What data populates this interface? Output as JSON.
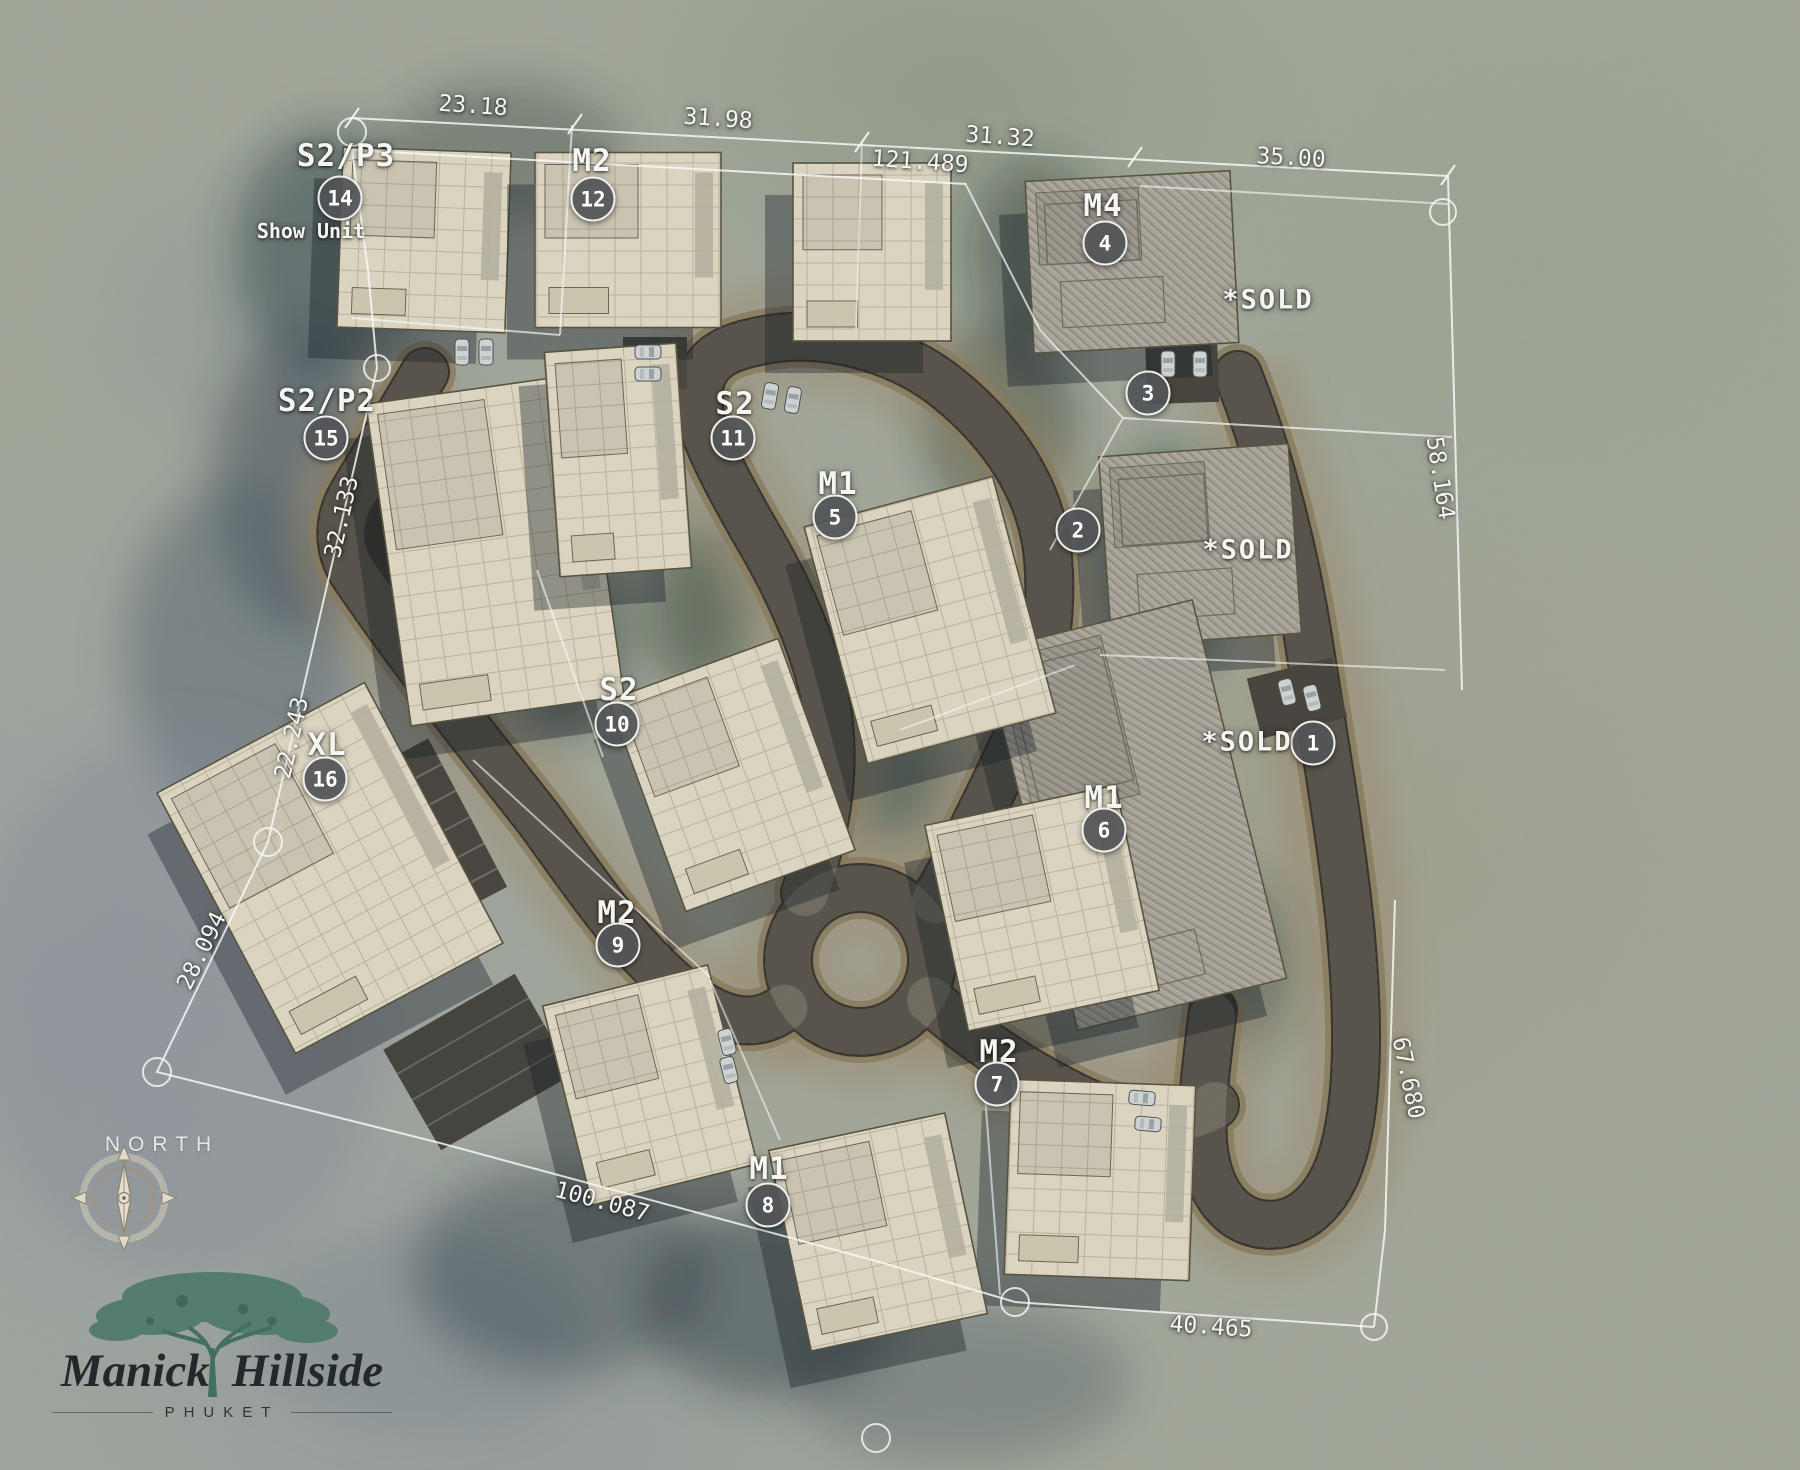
{
  "plots": [
    {
      "type": "S2/P3",
      "number": "14",
      "note": "Show Unit",
      "label": {
        "x": 346,
        "y": 156
      },
      "marker": {
        "x": 340,
        "y": 198
      },
      "note_pos": {
        "x": 311,
        "y": 231
      }
    },
    {
      "type": "M2",
      "number": "12",
      "note": "",
      "label": {
        "x": 592,
        "y": 161
      },
      "marker": {
        "x": 593,
        "y": 199
      }
    },
    {
      "type": "M4",
      "number": "4",
      "note": "",
      "label": {
        "x": 1103,
        "y": 206
      },
      "marker": {
        "x": 1105,
        "y": 243
      }
    },
    {
      "type": "S2",
      "number": "11",
      "note": "",
      "label": {
        "x": 735,
        "y": 404
      },
      "marker": {
        "x": 733,
        "y": 438
      }
    },
    {
      "type": "M1",
      "number": "5",
      "note": "",
      "label": {
        "x": 838,
        "y": 484
      },
      "marker": {
        "x": 835,
        "y": 517
      }
    },
    {
      "type": "S2/P2",
      "number": "15",
      "note": "",
      "label": {
        "x": 327,
        "y": 401
      },
      "marker": {
        "x": 326,
        "y": 438
      }
    },
    {
      "type": "S2",
      "number": "10",
      "note": "",
      "label": {
        "x": 619,
        "y": 690
      },
      "marker": {
        "x": 617,
        "y": 724
      }
    },
    {
      "type": "XL",
      "number": "16",
      "note": "",
      "label": {
        "x": 327,
        "y": 745
      },
      "marker": {
        "x": 325,
        "y": 779
      }
    },
    {
      "type": "M2",
      "number": "9",
      "note": "",
      "label": {
        "x": 617,
        "y": 913
      },
      "marker": {
        "x": 618,
        "y": 945
      }
    },
    {
      "type": "M1",
      "number": "6",
      "note": "",
      "label": {
        "x": 1104,
        "y": 798
      },
      "marker": {
        "x": 1104,
        "y": 830
      }
    },
    {
      "type": "M2",
      "number": "7",
      "note": "",
      "label": {
        "x": 999,
        "y": 1052
      },
      "marker": {
        "x": 997,
        "y": 1084
      }
    },
    {
      "type": "M1",
      "number": "8",
      "note": "",
      "label": {
        "x": 769,
        "y": 1169
      },
      "marker": {
        "x": 768,
        "y": 1205
      }
    },
    {
      "type": "",
      "number": "3",
      "note": "",
      "label": null,
      "marker": {
        "x": 1148,
        "y": 393
      }
    },
    {
      "type": "",
      "number": "2",
      "note": "",
      "label": null,
      "marker": {
        "x": 1078,
        "y": 530
      }
    },
    {
      "type": "",
      "number": "1",
      "note": "",
      "label": null,
      "marker": {
        "x": 1313,
        "y": 743
      }
    }
  ],
  "sold_labels": [
    {
      "text": "*SOLD",
      "x": 1268,
      "y": 300
    },
    {
      "text": "*SOLD",
      "x": 1248,
      "y": 550
    },
    {
      "text": "*SOLD",
      "x": 1247,
      "y": 742
    }
  ],
  "dimensions": [
    {
      "text": "23.18",
      "x": 473,
      "y": 106,
      "rotation": 4
    },
    {
      "text": "31.98",
      "x": 718,
      "y": 119,
      "rotation": 4
    },
    {
      "text": "31.32",
      "x": 1000,
      "y": 137,
      "rotation": 4
    },
    {
      "text": "121.489",
      "x": 920,
      "y": 162,
      "rotation": 4
    },
    {
      "text": "35.00",
      "x": 1291,
      "y": 158,
      "rotation": 3
    },
    {
      "text": "58.164",
      "x": 1440,
      "y": 478,
      "rotation": 81
    },
    {
      "text": "32.133",
      "x": 342,
      "y": 517,
      "rotation": -77
    },
    {
      "text": "22.243",
      "x": 292,
      "y": 738,
      "rotation": -77
    },
    {
      "text": "28.094",
      "x": 202,
      "y": 951,
      "rotation": -64
    },
    {
      "text": "100.087",
      "x": 602,
      "y": 1202,
      "rotation": 15
    },
    {
      "text": "40.465",
      "x": 1211,
      "y": 1327,
      "rotation": 4
    },
    {
      "text": "67.680",
      "x": 1408,
      "y": 1078,
      "rotation": 78
    }
  ],
  "north": {
    "label": "NORTH",
    "x": 162,
    "y": 1145
  },
  "logo": {
    "line1": "Manick",
    "line2": "Hillside",
    "subtitle": "PHUKET"
  },
  "colors": {
    "road": "#37342d",
    "road_edge": "#8a7b5e",
    "terrain": "#a3a89c",
    "house": "#ded8c4",
    "sold_roof": "#a8a399",
    "boundary": "#ffffff",
    "marker_fill": "#525457",
    "logo_teal": "#527c6f",
    "logo_ink": "#23282c"
  }
}
